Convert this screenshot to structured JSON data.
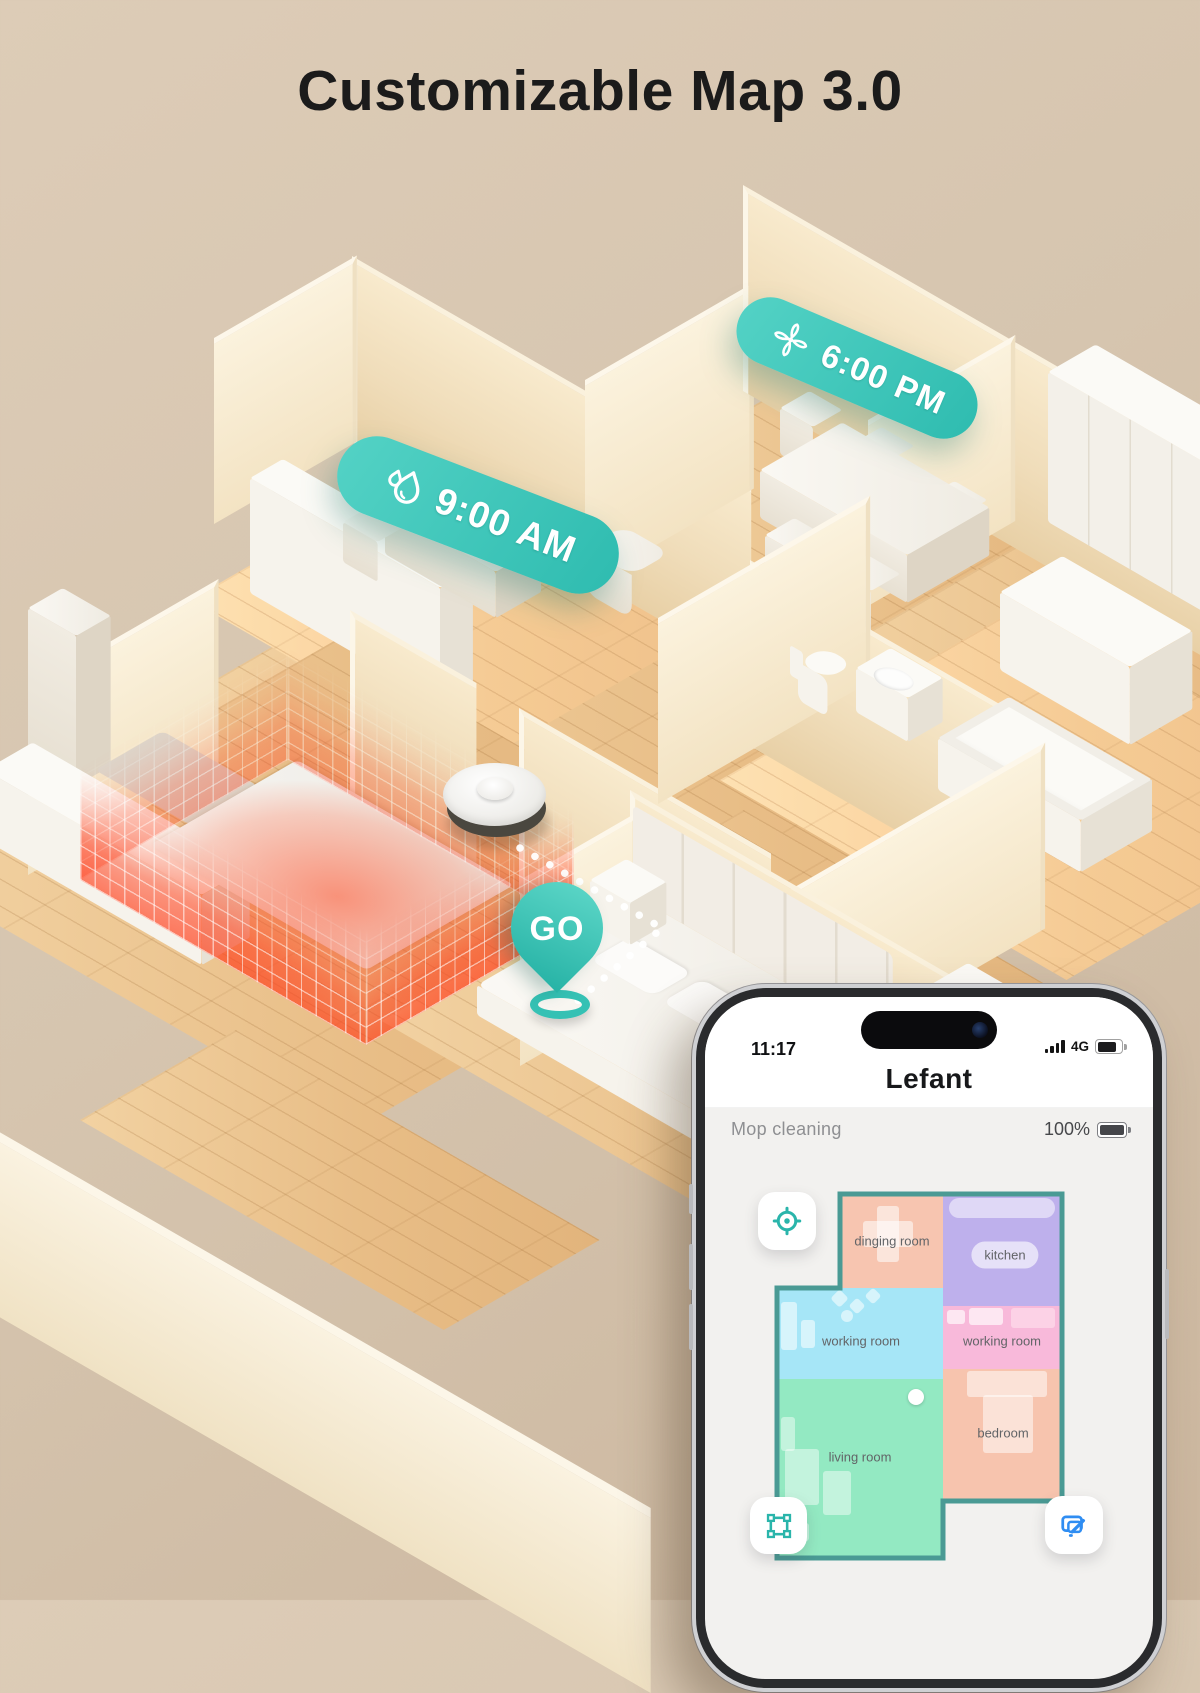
{
  "title": "Customizable Map 3.0",
  "badges": [
    {
      "name": "mop-schedule-badge",
      "icon": "water-drop-icon",
      "time": "9:00 AM"
    },
    {
      "name": "vacuum-schedule-badge",
      "icon": "fan-icon",
      "time": "6:00 PM"
    }
  ],
  "go_pin": {
    "label": "GO",
    "icon": "location-pin-icon"
  },
  "scene": {
    "elements": [
      "3d-floorplan",
      "robot-vacuum",
      "no-go-zone-grid",
      "dotted-path"
    ]
  },
  "phone": {
    "status_bar": {
      "time": "11:17",
      "network": "4G",
      "icons": [
        "signal-bars-icon",
        "battery-icon"
      ]
    },
    "app_title": "Lefant",
    "status_row": {
      "mode": "Mop cleaning",
      "battery": "100%"
    },
    "map": {
      "outline_color": "#4a9a94",
      "rooms": [
        {
          "label": "dinging room",
          "color": "#f7c5b0"
        },
        {
          "label": "kitchen",
          "color": "#beb0ec"
        },
        {
          "label": "working room",
          "color": "#a6e6f7"
        },
        {
          "label": "working room",
          "color": "#f8b9da"
        },
        {
          "label": "living room",
          "color": "#93e9c2"
        },
        {
          "label": "bedroom",
          "color": "#f7c4ae"
        }
      ]
    },
    "buttons": [
      {
        "name": "locate-button",
        "icon": "crosshair-icon",
        "color": "#2ab5ab"
      },
      {
        "name": "zone-button",
        "icon": "zone-frame-icon",
        "color": "#2ab5ab"
      },
      {
        "name": "map-edit-button",
        "icon": "map-edit-icon",
        "color": "#2f8df2"
      }
    ]
  },
  "colors": {
    "accent_teal": "#3fc6bc",
    "background": "#d6c5af",
    "no_go_red": "#ff4226",
    "wood": "#e8bd86",
    "wall": "#f3e3c3"
  }
}
